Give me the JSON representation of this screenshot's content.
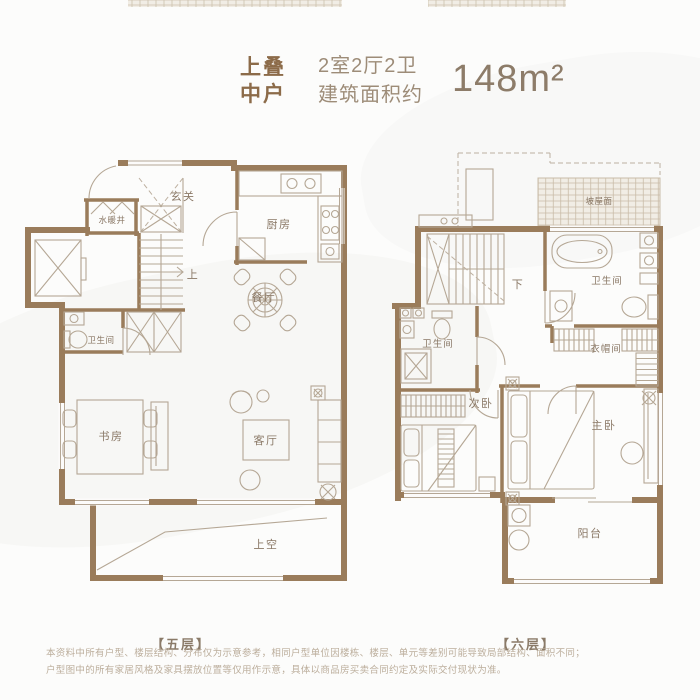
{
  "header": {
    "tag_line1": "上叠",
    "tag_line2": "中户",
    "spec_line1": "2室2厅2卫",
    "spec_line2": "建筑面积约",
    "area": "148m²"
  },
  "floor5": {
    "caption": "【五层】",
    "rooms": {
      "entrance": "玄关",
      "utility_shaft": "水暖井",
      "kitchen": "厨房",
      "stairs_up": "上",
      "dining_room": "餐厅",
      "bathroom": "卫生间",
      "study": "书房",
      "living_room": "客厅",
      "void_above": "上空"
    }
  },
  "floor6": {
    "caption": "【六层】",
    "rooms": {
      "sloped_roof": "坡屋面",
      "stairs_down": "下",
      "master_bathroom": "卫生间",
      "second_bathroom": "卫生间",
      "cloakroom": "衣帽间",
      "second_bedroom": "次卧",
      "master_bedroom": "主卧",
      "balcony": "阳台"
    }
  },
  "footer": {
    "line1": "本资料中所有户型、楼层结构、分布仅为示意参考，相同户型单位因楼栋、楼层、单元等差别可能导致局部结构、面积不同；",
    "line2": "户型图中的所有家居风格及家具摆放位置等仅用作示意，具体以商品房买卖合同约定及实际交付现状为准。"
  },
  "colors": {
    "wall": "#9a7c5b",
    "thin_line": "#b5a795",
    "room_label": "#8a7866",
    "accent_text": "#8c6b49",
    "area_text": "#8d7c69",
    "footer_text": "#bcae9c"
  }
}
